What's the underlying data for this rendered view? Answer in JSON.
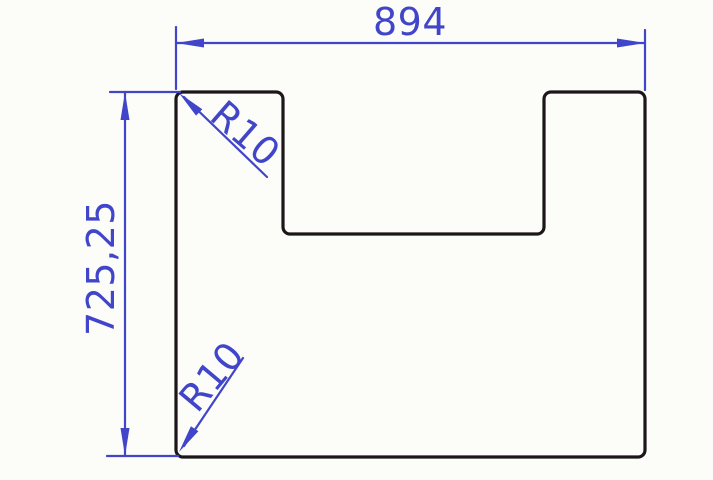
{
  "drawing": {
    "type": "technical-dimension-drawing",
    "part": {
      "shape": "rectangular plate with top center notch and rounded corners"
    },
    "dimensions": {
      "width_label": "894",
      "height_label": "725,25",
      "radius_top_label": "R10",
      "radius_bottom_label": "R10"
    },
    "colors": {
      "dimension_blue": "#4145c9",
      "outline_black": "#1c1519",
      "background": "#fcfcf9"
    }
  }
}
